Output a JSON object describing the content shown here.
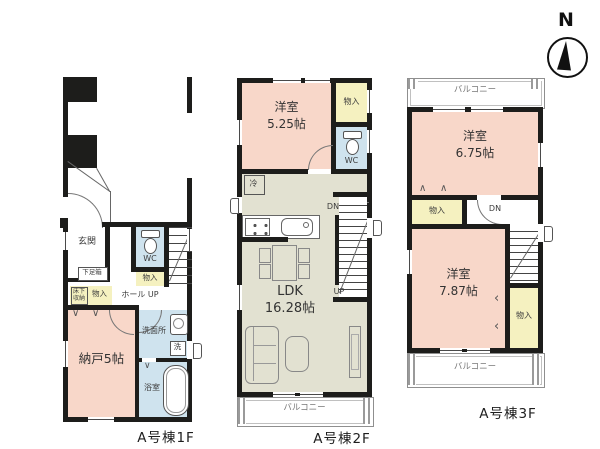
{
  "compass": {
    "north": "N"
  },
  "floor1": {
    "name": "A号棟1F",
    "genkan": "玄関",
    "shoe_box": "下足箱",
    "wc": "WC",
    "wc_closet": "物入",
    "underfloor_storage": "床下収納",
    "hall_closet": "物入",
    "hall": "ホール",
    "up": "UP",
    "storage_room": "納戸5帖",
    "washroom": "洗面所",
    "washer": "洗",
    "bathroom": "浴室"
  },
  "floor2": {
    "name": "A号棟2F",
    "bedroom": "洋室",
    "bedroom_size": "5.25帖",
    "closet": "物入",
    "wc": "WC",
    "fridge": "冷",
    "down": "DN",
    "up": "UP",
    "ldk": "LDK",
    "ldk_size": "16.28帖",
    "balcony": "バルコニー"
  },
  "floor3": {
    "name": "A号棟3F",
    "balcony_top": "バルコニー",
    "bedroom1": "洋室",
    "bedroom1_size": "6.75帖",
    "closet1": "物入",
    "down": "DN",
    "bedroom2": "洋室",
    "bedroom2_size": "7.87帖",
    "closet2": "物入",
    "balcony_bottom": "バルコニー"
  },
  "colors": {
    "room_pink": "#f8d7c9",
    "closet_yellow": "#f5f1c0",
    "wet_blue": "#cfe3ee",
    "ldk_beige": "#e2e1d1",
    "wall_black": "#1d1d1b"
  }
}
